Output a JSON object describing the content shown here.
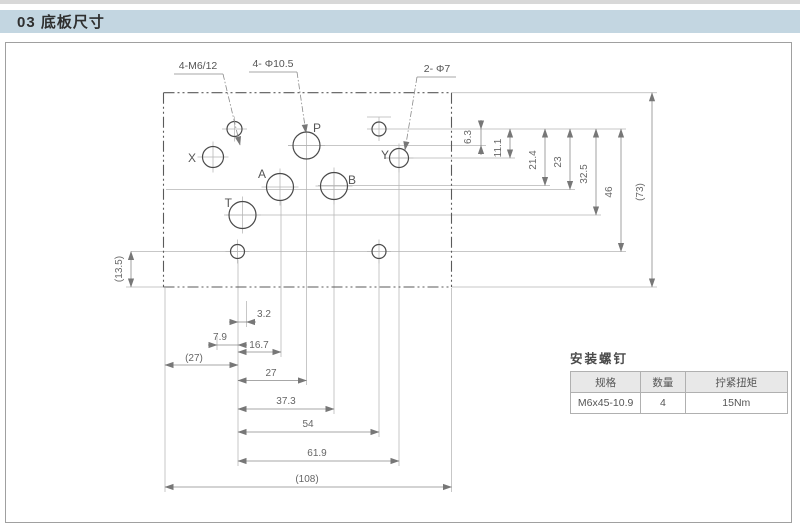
{
  "page": {
    "strip": "",
    "title": "03 底板尺寸"
  },
  "drawing": {
    "callouts": {
      "m6": "4-M6/12",
      "d105": "4- Φ10.5",
      "d7": "2- Φ7"
    },
    "ports": {
      "p": "P",
      "x": "X",
      "y": "Y",
      "a": "A",
      "b": "B",
      "t": "T"
    },
    "dims": {
      "d3_2": "3.2",
      "d7_9": "7.9",
      "d16_7": "16.7",
      "d27b": "(27)",
      "d27": "27",
      "d37_3": "37.3",
      "d54": "54",
      "d61_9": "61.9",
      "d108": "(108)",
      "d6_3": "6.3",
      "d11_1": "11.1",
      "d21_4": "21.4",
      "d23": "23",
      "d32_5": "32.5",
      "d46": "46",
      "d73": "(73)",
      "d13_5": "(13.5)"
    }
  },
  "table": {
    "title": "安装螺钉",
    "headers": [
      "规格",
      "数量",
      "拧紧扭矩"
    ],
    "row": [
      "M6x45-10.9",
      "4",
      "15Nm"
    ]
  }
}
